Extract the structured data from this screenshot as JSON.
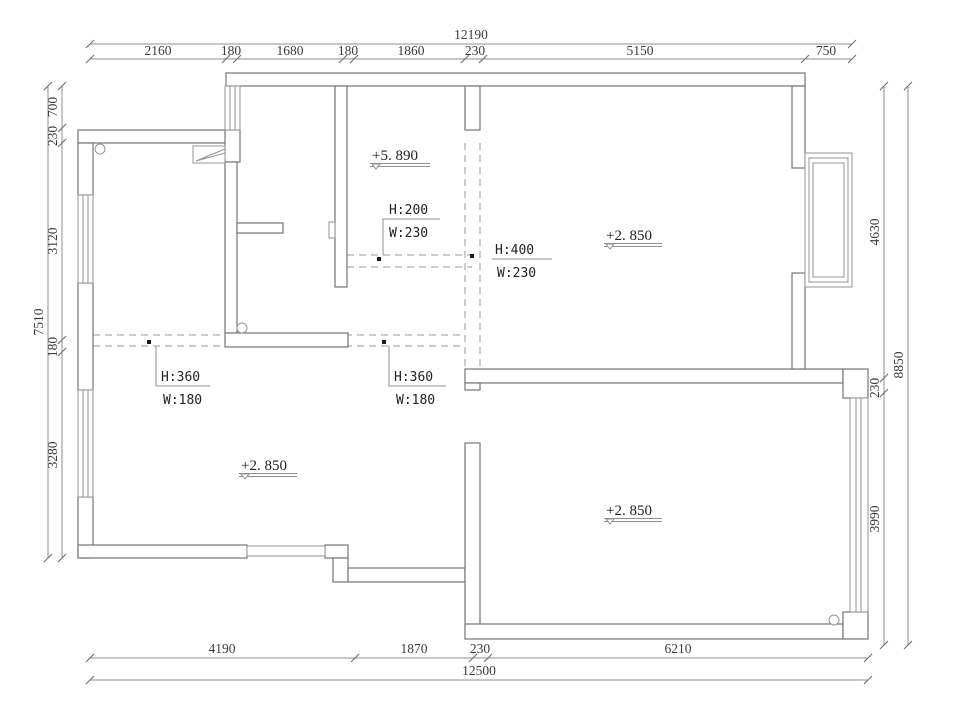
{
  "plan": {
    "dimensions": {
      "top": {
        "total": "12190",
        "segments": [
          "2160",
          "180",
          "1680",
          "180",
          "1860",
          "230",
          "5150",
          "750"
        ]
      },
      "bottom": {
        "total": "12500",
        "segments": [
          "4190",
          "1870",
          "230",
          "6210"
        ]
      },
      "left": {
        "total": "7510",
        "segments": [
          "700",
          "230",
          "3120",
          "180",
          "3280"
        ]
      },
      "right": {
        "total": "8850",
        "segments": [
          "4630",
          "230",
          "3990"
        ]
      }
    },
    "levels": {
      "upper_hall": "+5. 890",
      "top_right_room": "+2. 850",
      "bottom_left_room": "+2. 850",
      "bottom_right_room": "+2. 850"
    },
    "openings": {
      "o1": {
        "height": "H:200",
        "width": "W:230"
      },
      "o2": {
        "height": "H:400",
        "width": "W:230"
      },
      "o3": {
        "height": "H:360",
        "width": "W:180"
      },
      "o4": {
        "height": "H:360",
        "width": "W:180"
      }
    },
    "colors": {
      "background": "#ffffff",
      "wall_line": "#767676",
      "dimension_line": "#8f8f8f",
      "text": "#222222"
    }
  }
}
